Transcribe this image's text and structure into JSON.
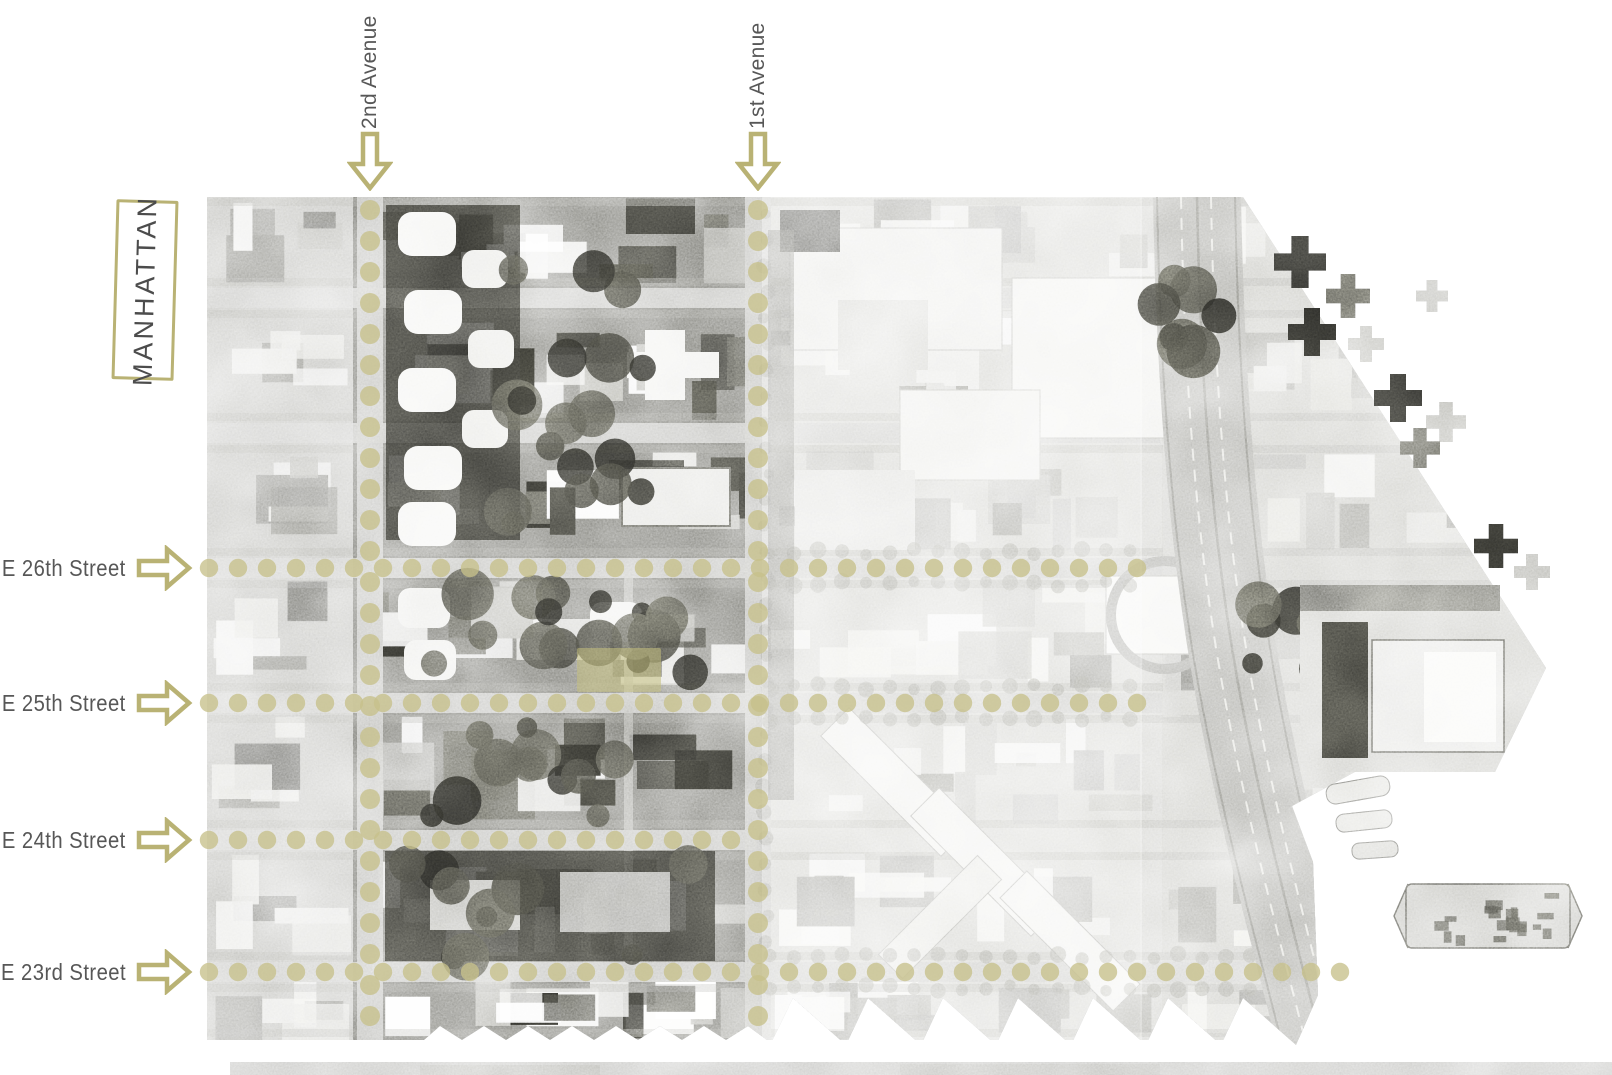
{
  "figure": {
    "title_region": "MANHATTAN",
    "colors": {
      "accent": "#b9b274",
      "dots": "#c6c08a",
      "label_text": "#575757",
      "highlight": "#c5bf7d"
    }
  },
  "avenues": [
    {
      "label": "2nd Avenue",
      "x": 370
    },
    {
      "label": "1st Avenue",
      "x": 758
    }
  ],
  "streets": [
    {
      "label": "E 26th Street",
      "y": 568,
      "dots_to": 1162
    },
    {
      "label": "E 25th Street",
      "y": 703,
      "dots_to": 1162
    },
    {
      "label": "E 24th Street",
      "y": 840,
      "dots_to": 757
    },
    {
      "label": "E 23rd Street",
      "y": 972,
      "dots_to": 1352
    }
  ],
  "site_highlight": {
    "x": 577,
    "y": 648,
    "w": 84,
    "h": 44
  }
}
